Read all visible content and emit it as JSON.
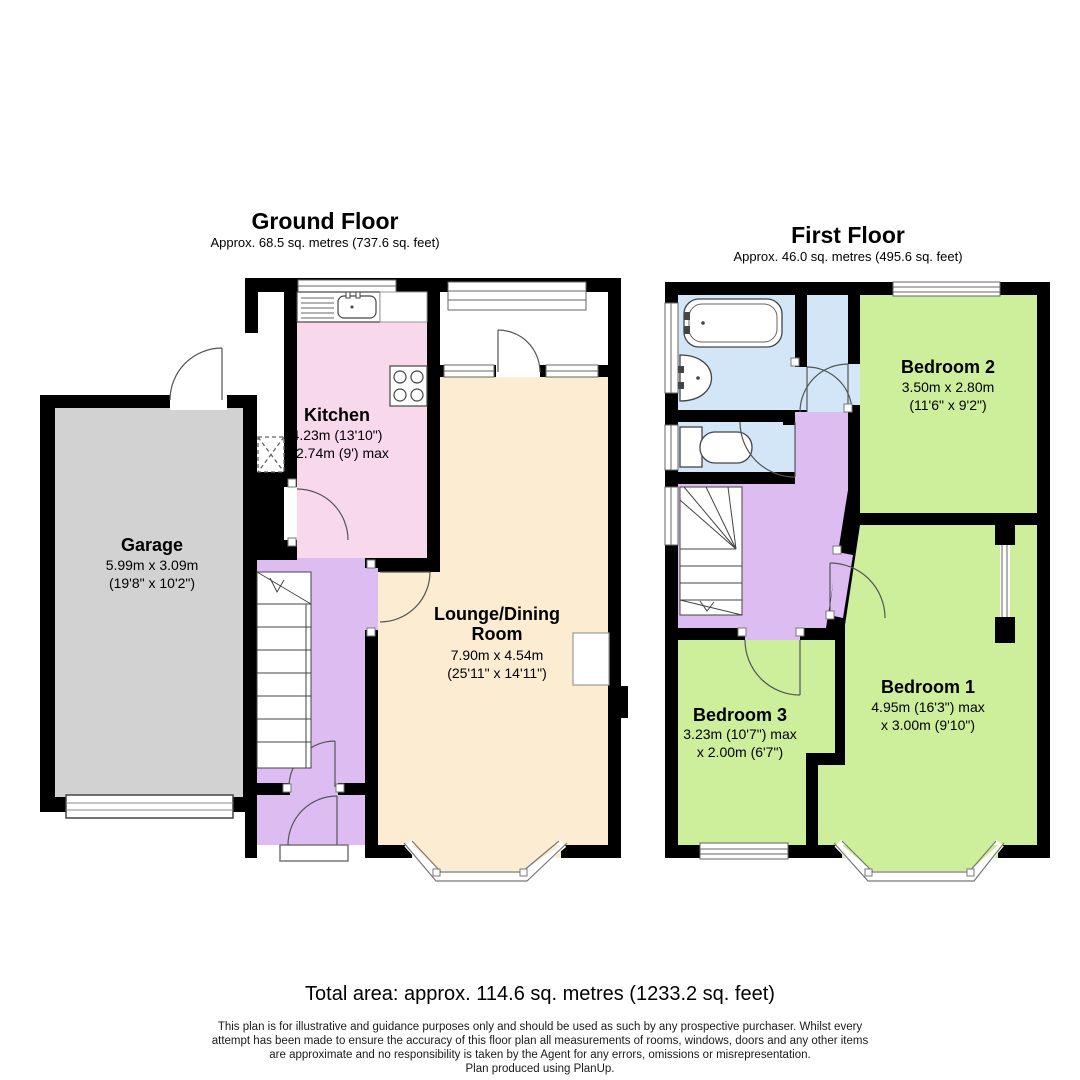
{
  "ground_floor": {
    "title": "Ground Floor",
    "subtitle": "Approx. 68.5 sq. metres (737.6 sq. feet)",
    "rooms": {
      "garage": {
        "name": "Garage",
        "dim1": "5.99m x 3.09m",
        "dim2": "(19'8\" x 10'2\")"
      },
      "kitchen": {
        "name": "Kitchen",
        "dim1": "4.23m (13'10\")",
        "dim2": "x 2.74m (9') max"
      },
      "lounge": {
        "name": "Lounge/Dining",
        "name_line2": "Room",
        "dim1": "7.90m x 4.54m",
        "dim2": "(25'11\" x 14'11\")"
      }
    }
  },
  "first_floor": {
    "title": "First Floor",
    "subtitle": "Approx. 46.0 sq. metres (495.6 sq. feet)",
    "rooms": {
      "bedroom1": {
        "name": "Bedroom 1",
        "dim1": "4.95m (16'3\") max",
        "dim2": "x 3.00m (9'10\")"
      },
      "bedroom2": {
        "name": "Bedroom 2",
        "dim1": "3.50m x 2.80m",
        "dim2": "(11'6\" x 9'2\")"
      },
      "bedroom3": {
        "name": "Bedroom 3",
        "dim1": "3.23m (10'7\") max",
        "dim2": "x 2.00m (6'7\")"
      }
    }
  },
  "footer": {
    "total_area": "Total area: approx. 114.6 sq. metres (1233.2 sq. feet)",
    "disclaimer_line1": "This plan is for illustrative and guidance purposes only and should be used as such by any prospective purchaser. Whilst every",
    "disclaimer_line2": "attempt has been made to ensure the accuracy of this floor plan all measurements of rooms, windows, doors and any other items",
    "disclaimer_line3": "are approximate and no responsibility is taken by the Agent for any errors, omissions or misrepresentation.",
    "disclaimer_line4": "Plan produced using PlanUp."
  },
  "colors": {
    "wall": "#000000",
    "garage": "#d2d2d2",
    "kitchen": "#f8d9ec",
    "lounge": "#fbecd2",
    "hall": "#ddbcf2",
    "bathroom": "#d2e6f8",
    "bedroom": "#cdee9b",
    "fixture_line": "#555555"
  }
}
